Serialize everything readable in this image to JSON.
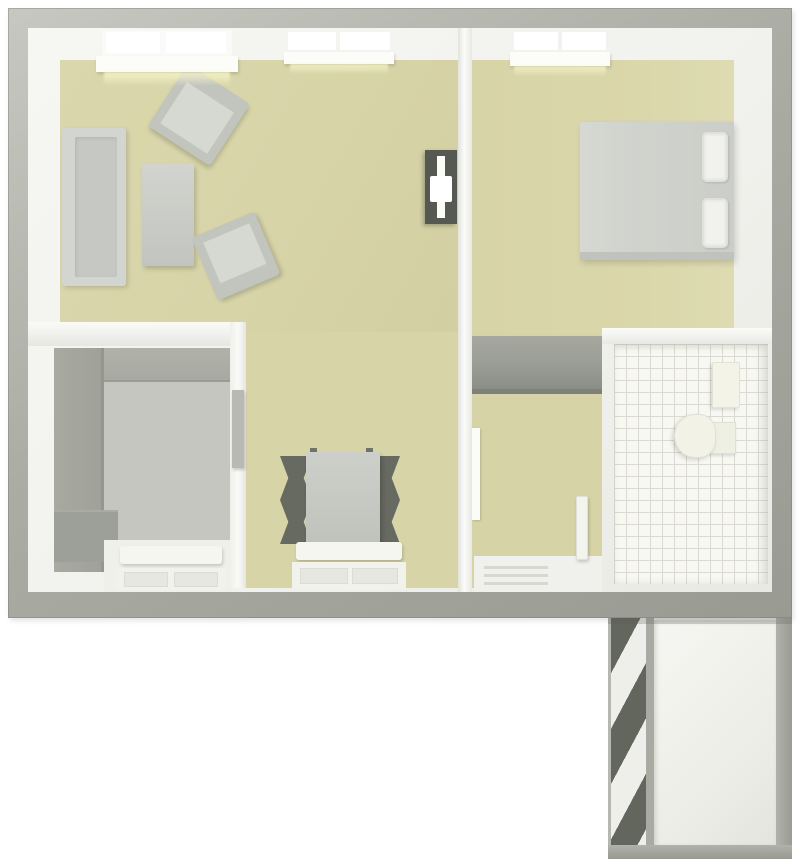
{
  "meta": {
    "title": "3D apartment floor plan, top-down view",
    "type": "floor-plan-render",
    "text_visible": false
  },
  "palette": {
    "bg": "#ffffff",
    "wallOuter": "#abada5",
    "wallOuterLight": "#c6c8c1",
    "wallOuterDark": "#999b93",
    "wallInner": "#f1f1ed",
    "floorLiving": "#d7d4a8",
    "floorBedroom": "#dad7ab",
    "floorHall": "#d6d3a7",
    "floorKitchen": "#c5c6c0",
    "counter": "#a8aaa2",
    "counterDark": "#9da098",
    "tileBg": "#f8f8f3",
    "tileLine": "#dadad2",
    "furnGray": "#c6c8c3",
    "furnGrayLight": "#d3d5d0",
    "furnGrayFrame": "#c2c4be",
    "furnGraySeat": "#d6d8d2",
    "bedDuvet": "#d1d3ce",
    "white": "#f6f6f1",
    "chairDark": "#676a61",
    "tvDark": "#565951",
    "wardrobe": "#9a9d95",
    "wardrobeDark": "#8b8e86",
    "stairsDark": "#63665d"
  },
  "rooms": [
    {
      "id": "living-room",
      "floor": "beige",
      "furniture": [
        "sofa",
        "coffee-table",
        "armchair-1",
        "armchair-2",
        "tv-stand",
        "window-large",
        "window-double"
      ]
    },
    {
      "id": "dining-area",
      "floor": "beige",
      "furniture": [
        "dining-table",
        "dining-chair x4",
        "radiator",
        "window"
      ]
    },
    {
      "id": "bedroom",
      "floor": "beige",
      "furniture": [
        "double-bed",
        "pillow x2",
        "window-double"
      ]
    },
    {
      "id": "kitchen",
      "floor": "gray",
      "furniture": [
        "l-shaped-counter",
        "counter-step",
        "radiator",
        "window"
      ]
    },
    {
      "id": "hallway",
      "floor": "beige",
      "furniture": [
        "wardrobe",
        "entrance-mat",
        "door-leaf x3"
      ]
    },
    {
      "id": "bathroom",
      "floor": "white-tile",
      "furniture": [
        "sink",
        "toilet"
      ]
    },
    {
      "id": "stair-landing",
      "floor": "white",
      "furniture": [
        "staircase-stripes"
      ]
    }
  ]
}
